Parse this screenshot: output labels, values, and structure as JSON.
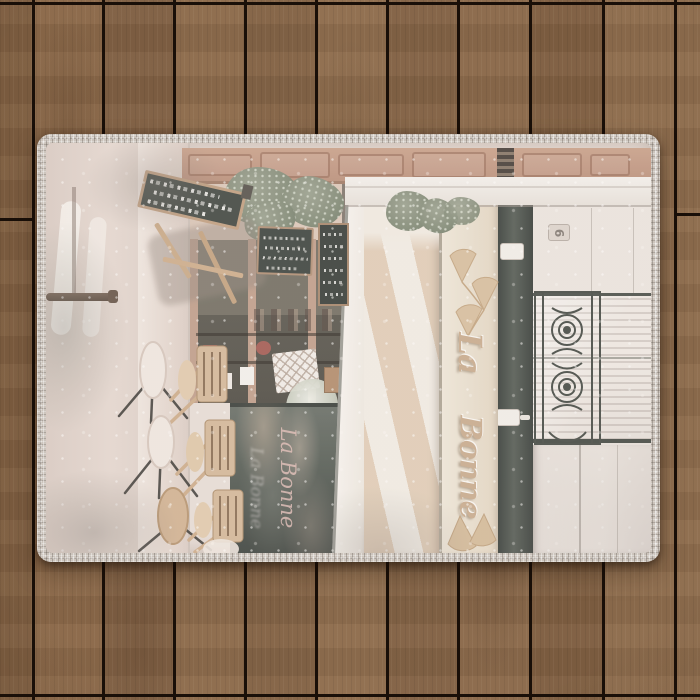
{
  "rug_print": {
    "awning_script_line1": "La",
    "awning_script_line2": "Bonne",
    "door_plaque_number": "6",
    "window_reflection_script": "La Bonne"
  },
  "palette": {
    "wood_plank": "#856446",
    "plank_gap": "#190f08",
    "rug_border_stitch": "#ccc4bc",
    "photo_base": "#e9dcd3",
    "awning_stripe_tan": "#e4ccb2",
    "awning_stripe_cream": "#f2ebe1",
    "window_glass": "#5c645b",
    "chalkboard": "#3f463f",
    "foliage": "#828c74",
    "relief_script": "#cdab87",
    "facade_wood": "#c28f76"
  }
}
